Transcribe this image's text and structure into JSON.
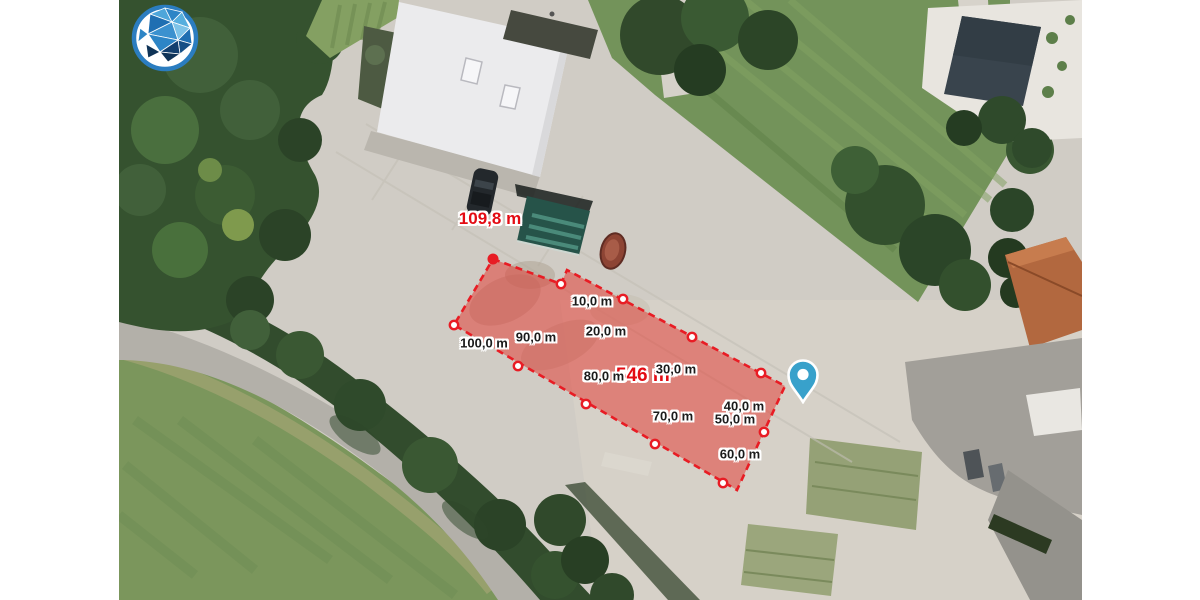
{
  "branding": {
    "logo_name": "bavaria-geoportal-logo",
    "ring_color": "#2b7dc0",
    "logo_blues": [
      "#4ea6da",
      "#2d85c6",
      "#1f6fb2",
      "#56aede",
      "#7ec3e8",
      "#3b91cf",
      "#164f86",
      "#123f6e",
      "#0f3357"
    ]
  },
  "measurement": {
    "tool": "area-measurement",
    "total_length": "109,8 m",
    "total_length_pos": {
      "x": 490,
      "y": 219
    },
    "area": "546 m²",
    "area_pos": {
      "x": 646,
      "y": 376
    },
    "stroke_color": "#e81c24",
    "fill_color": "rgba(228,52,44,0.5)",
    "label_color": "#1b1b1b",
    "polygon": [
      [
        493,
        259
      ],
      [
        561,
        284
      ],
      [
        567,
        270
      ],
      [
        785,
        386
      ],
      [
        737,
        490
      ],
      [
        454,
        325
      ]
    ],
    "endpoint": {
      "x": 493,
      "y": 259
    },
    "markers": [
      {
        "label": "10,0 m",
        "x": 561,
        "y": 284,
        "lx": 592,
        "ly": 301
      },
      {
        "label": "20,0 m",
        "x": 623,
        "y": 299,
        "lx": 606,
        "ly": 331
      },
      {
        "label": "30,0 m",
        "x": 692,
        "y": 337,
        "lx": 676,
        "ly": 369
      },
      {
        "label": "40,0 m",
        "x": 761,
        "y": 373,
        "lx": 744,
        "ly": 406
      },
      {
        "label": "50,0 m",
        "x": 764,
        "y": 432,
        "lx": 735,
        "ly": 419
      },
      {
        "label": "60,0 m",
        "x": 723,
        "y": 483,
        "lx": 740,
        "ly": 454
      },
      {
        "label": "70,0 m",
        "x": 655,
        "y": 444,
        "lx": 673,
        "ly": 416
      },
      {
        "label": "80,0 m",
        "x": 586,
        "y": 404,
        "lx": 604,
        "ly": 376
      },
      {
        "label": "90,0 m",
        "x": 518,
        "y": 366,
        "lx": 536,
        "ly": 337
      },
      {
        "label": "100,0 m",
        "x": 454,
        "y": 325,
        "lx": 484,
        "ly": 343
      }
    ]
  },
  "pin": {
    "x": 803,
    "y": 404,
    "color": "#38a1cb"
  }
}
